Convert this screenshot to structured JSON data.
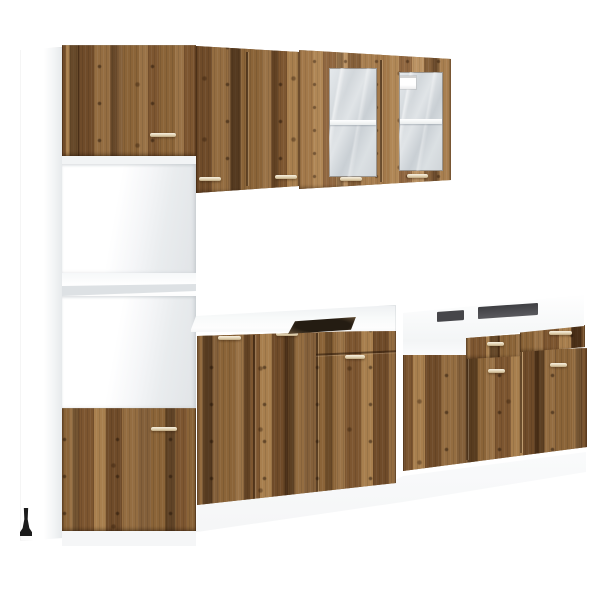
{
  "image": {
    "type": "product-photo",
    "subject": "Rustic reclaimed-wood style kitchen cabinet set on white background"
  },
  "colors": {
    "background": "#ffffff",
    "wood-base": "#84603a",
    "wood-dark-streak": "#4a3520",
    "wood-light": "#a87f4e",
    "carcass-white": "#ffffff",
    "carcass-shade": "#e1e4e7",
    "glass": "#c9cfd4",
    "handle-hi": "#f6efdf",
    "handle-lo": "#bda67f",
    "cutout-dark": "#241c12",
    "slot-dark": "#46464a",
    "plinth": "#f3f4f5",
    "foot-black": "#1c1c1c"
  },
  "units": {
    "tall_cabinet": {
      "label": "Tall oven housing cabinet: wood door top, two open white compartments, wood door bottom",
      "doors": 2,
      "open_compartments": 2,
      "handles": 2,
      "feet_visible": 1
    },
    "wall_cabinet_solid": {
      "label": "Wall cabinet with two solid wood doors",
      "doors": 2,
      "handles": 2
    },
    "wall_cabinet_glass": {
      "label": "Wall cabinet with two glass doors, white shelf inside, small white sticker on right pane",
      "doors": 2,
      "handles": 2,
      "shelves_visible": 2,
      "sticker": true
    },
    "base_cabinet_middle": {
      "label": "Base cabinet, white top with dark hob cutout, two doors plus drawer-over-door column",
      "doors": 3,
      "drawers": 1,
      "handles": 4
    },
    "base_cabinet_sink": {
      "label": "Open-top sink base cabinet, white carcass showing, two drawers and doors below",
      "doors": 2,
      "drawers": 2,
      "handles": 4
    }
  },
  "details": {
    "handle_style": "thin horizontal metal bar",
    "total_handles": 14,
    "plinth": "white recessed plinth band under all base units",
    "perspective": "slight left-side one-point perspective"
  }
}
